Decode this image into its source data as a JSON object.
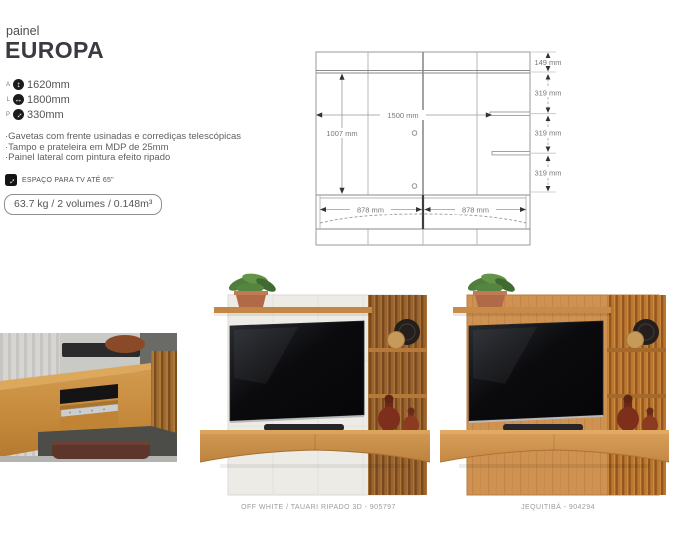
{
  "header": {
    "category": "painel",
    "name": "EUROPA"
  },
  "specs": [
    {
      "key": "A",
      "icon": "height-arrows-icon",
      "glyph": "↕",
      "value": "1620mm"
    },
    {
      "key": "L",
      "icon": "width-arrows-icon",
      "glyph": "↔",
      "value": "1800mm"
    },
    {
      "key": "P",
      "icon": "depth-arrows-icon",
      "glyph": "↔",
      "value": "330mm"
    }
  ],
  "features": [
    "·Gavetas com frente usinadas e corrediças telescópicas",
    "·Tampo e prateleira em MDP de 25mm",
    "·Painel lateral com pintura efeito ripado"
  ],
  "tv_badge": {
    "icon": "tv-size-arrow-icon",
    "glyph": "↔",
    "label": "ESPAÇO PARA TV ATÉ 65\""
  },
  "logistics": "63.7 kg / 2 volumes / 0.148m³",
  "drawing": {
    "dim_149": "149 mm",
    "dim_319_a": "319 mm",
    "dim_319_b": "319 mm",
    "dim_319_c": "319 mm",
    "dim_1500": "1500 mm",
    "dim_1007": "1007 mm",
    "dim_878_left": "878 mm",
    "dim_878_right": "878 mm"
  },
  "variants": {
    "middle_caption": "OFF WHITE / TAUARI RIPADO 3D - 905797",
    "right_caption": "JEQUITIBÁ - 904294"
  },
  "colors": {
    "title_text": "#3a3a40",
    "body_text": "#555555",
    "drawing_line": "#999999",
    "wood": "#c68c44",
    "wood_dark": "#8f5a2b",
    "off_white_panel": "#edebe6",
    "vase_amber": "#7e2f1c"
  }
}
